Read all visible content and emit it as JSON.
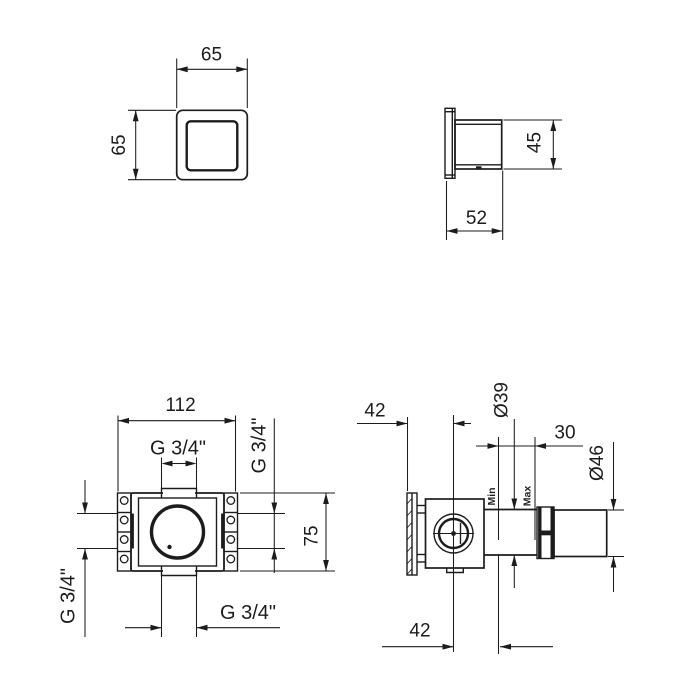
{
  "views": {
    "trim_front": {
      "dim_width": "65",
      "dim_height": "65"
    },
    "trim_side": {
      "dim_body_depth": "45",
      "dim_total_depth": "52"
    },
    "valve_front": {
      "dim_width": "112",
      "dim_height": "75",
      "port_top_thread": "G 3/4\"",
      "port_right_thread": "G 3/4\"",
      "port_left_thread": "G 3/4\"",
      "port_bottom_thread": "G 3/4\""
    },
    "valve_side": {
      "dim_wall_to_center": "42",
      "dim_neck_diameter": "Ø39",
      "dim_adjustment_range": "30",
      "dim_sleeve_diameter": "Ø46",
      "label_min": "Min",
      "label_max": "Max",
      "dim_center_to_min_wall": "42"
    }
  }
}
